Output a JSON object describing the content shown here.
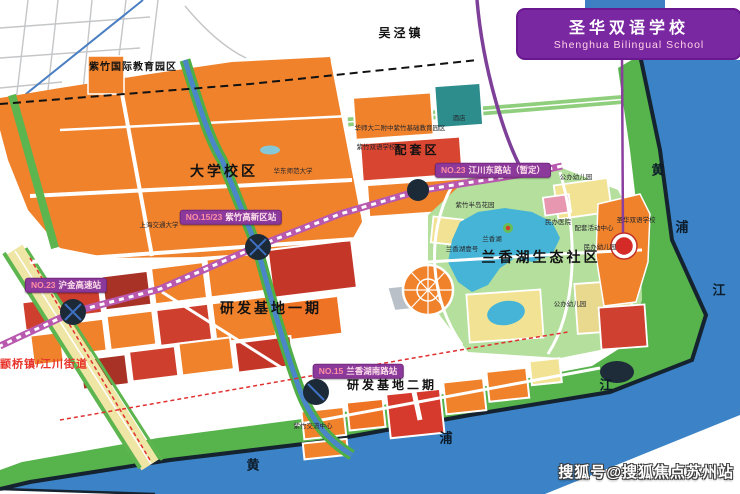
{
  "banner": {
    "title": "圣华双语学校",
    "subtitle": "Shenghua Bilingual School"
  },
  "watermark": "搜狐号@搜狐焦点苏州站",
  "colors": {
    "banner_bg": "#7a28a2",
    "banner_tab_blue": "#3e7ec3",
    "station_label_bg": "#8b3a9b",
    "metro_striped_line": "#b858ae",
    "metro_north_line": "#7d3f98",
    "river_blue": "#3b83c6",
    "shore_park_green": "#57b34b",
    "campus_orange": "#f0822c",
    "parcel_red": "#d0402e",
    "parcel_dark_red": "#a83226",
    "parcel_yellow": "#f2e394",
    "parcel_teal": "#2d8c8c",
    "lake_blue": "#45b4d6",
    "school_marker_red": "#d42a28",
    "district_text_red": "#e8332a"
  },
  "map": {
    "stations": [
      {
        "id": "zizhu-hitech-station",
        "prefix": "NO.15/23",
        "name": "紫竹高新区站",
        "x": 231,
        "y": 217
      },
      {
        "id": "jiangchuan-east-station",
        "prefix": "NO.23",
        "name": "江川东路站（暂定）",
        "x": 493,
        "y": 170
      },
      {
        "id": "hujin-expressway-station",
        "prefix": "NO.23",
        "name": "沪金高速站",
        "x": 66,
        "y": 285
      },
      {
        "id": "lanxianghu-south-station",
        "prefix": "NO.15",
        "name": "兰香湖南路站",
        "x": 358,
        "y": 371
      }
    ],
    "labels": [
      {
        "id": "wujing-town",
        "text": "吴泾镇",
        "x": 401,
        "y": 33,
        "cls": "zone"
      },
      {
        "id": "zizhu-intl-edu-park",
        "text": "紫竹国际教育园区",
        "x": 133,
        "y": 68,
        "cls": "zone-sm"
      },
      {
        "id": "university-campus",
        "text": "大学校区",
        "x": 224,
        "y": 171,
        "cls": "zone-lg"
      },
      {
        "id": "supporting-area",
        "text": "配套区",
        "x": 417,
        "y": 150,
        "cls": "zone"
      },
      {
        "id": "lanxiang-lake-eco-community",
        "text": "兰香湖生态社区",
        "x": 541,
        "y": 257,
        "cls": "zone-lg"
      },
      {
        "id": "rd-base-phase1",
        "text": "研发基地一期",
        "x": 271,
        "y": 308,
        "cls": "zone-lg"
      },
      {
        "id": "rd-base-phase2",
        "text": "研发基地二期",
        "x": 392,
        "y": 385,
        "cls": "zone"
      },
      {
        "id": "zhuanqiao-jiangchuan-street",
        "text": "颛桥镇/江川街道",
        "x": 44,
        "y": 365,
        "cls": "district"
      },
      {
        "id": "east-china-normal-university",
        "text": "华东师范大学",
        "x": 293,
        "y": 172,
        "cls": "univ"
      },
      {
        "id": "shanghai-jiaotong-university",
        "text": "上海交通大学",
        "x": 159,
        "y": 226,
        "cls": "univ"
      },
      {
        "id": "hsd-erfuzhong-edu-park",
        "text": "华师大二附中紫竹基础教育园区",
        "x": 400,
        "y": 129,
        "cls": "tiny"
      },
      {
        "id": "zizhu-bilingual-school",
        "text": "紫竹双语学校",
        "x": 376,
        "y": 148,
        "cls": "tiny"
      },
      {
        "id": "hotel",
        "text": "酒店",
        "x": 459,
        "y": 119,
        "cls": "tiny"
      },
      {
        "id": "zizhu-peninsula-garden",
        "text": "紫竹半岛花园",
        "x": 475,
        "y": 206,
        "cls": "tiny"
      },
      {
        "id": "lanxiang-lake",
        "text": "兰香湖",
        "x": 492,
        "y": 240,
        "cls": "tiny"
      },
      {
        "id": "lanxianghu-no1",
        "text": "兰香湖壹号",
        "x": 462,
        "y": 250,
        "cls": "tiny"
      },
      {
        "id": "private-hospital",
        "text": "民办医院",
        "x": 558,
        "y": 223,
        "cls": "tiny"
      },
      {
        "id": "activity-center",
        "text": "配套活动中心",
        "x": 594,
        "y": 229,
        "cls": "tiny"
      },
      {
        "id": "shenghua-school-site",
        "text": "圣华双语学校",
        "x": 636,
        "y": 221,
        "cls": "tiny"
      },
      {
        "id": "private-kindergarten",
        "text": "民办幼儿园",
        "x": 600,
        "y": 248,
        "cls": "tiny"
      },
      {
        "id": "public-kindergarten-north",
        "text": "公办幼儿园",
        "x": 576,
        "y": 178,
        "cls": "tiny"
      },
      {
        "id": "public-kindergarten-south",
        "text": "公办幼儿园",
        "x": 570,
        "y": 305,
        "cls": "tiny"
      },
      {
        "id": "zizhu-exchange-center",
        "text": "紫竹交流中心",
        "x": 313,
        "y": 427,
        "cls": "tiny"
      },
      {
        "id": "huangpu-river-right-huang",
        "text": "黄",
        "x": 658,
        "y": 170,
        "cls": "river"
      },
      {
        "id": "huangpu-river-right-pu",
        "text": "浦",
        "x": 682,
        "y": 227,
        "cls": "river"
      },
      {
        "id": "huangpu-river-right-jiang",
        "text": "江",
        "x": 719,
        "y": 290,
        "cls": "river"
      },
      {
        "id": "huangpu-river-bottom-huang",
        "text": "黄",
        "x": 253,
        "y": 465,
        "cls": "river"
      },
      {
        "id": "huangpu-river-bottom-pu",
        "text": "浦",
        "x": 446,
        "y": 438,
        "cls": "river"
      },
      {
        "id": "huangpu-river-bottom-jiang",
        "text": "江",
        "x": 606,
        "y": 385,
        "cls": "river"
      }
    ]
  }
}
